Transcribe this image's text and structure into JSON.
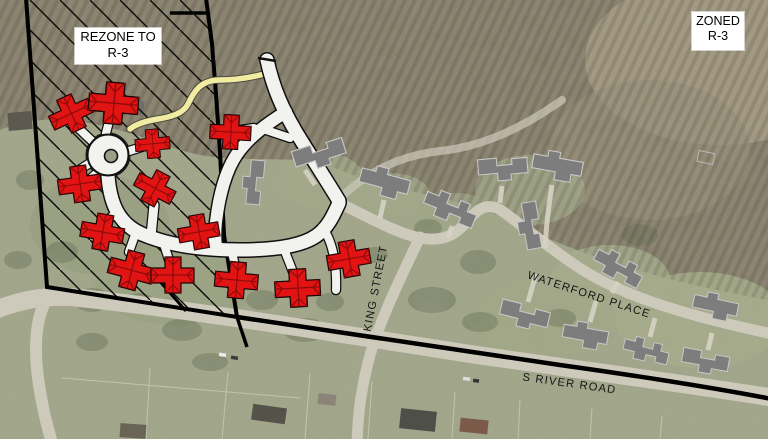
{
  "title": "Rezoning exhibit aerial map",
  "labels": {
    "rezone_line1": "REZONE TO",
    "rezone_line2": "R-3",
    "zoned_line1": "ZONED",
    "zoned_line2": "R-3"
  },
  "streets": {
    "king": "KING STREET",
    "waterford": "WATERFORD PLACE",
    "s_river": "S RIVER ROAD"
  },
  "colors": {
    "proposed_building": "#e21313",
    "existing_building": "#7d7d7d",
    "proposed_road": "#f2f2ef",
    "trail": "#f1eca2",
    "boundary": "#000000"
  }
}
